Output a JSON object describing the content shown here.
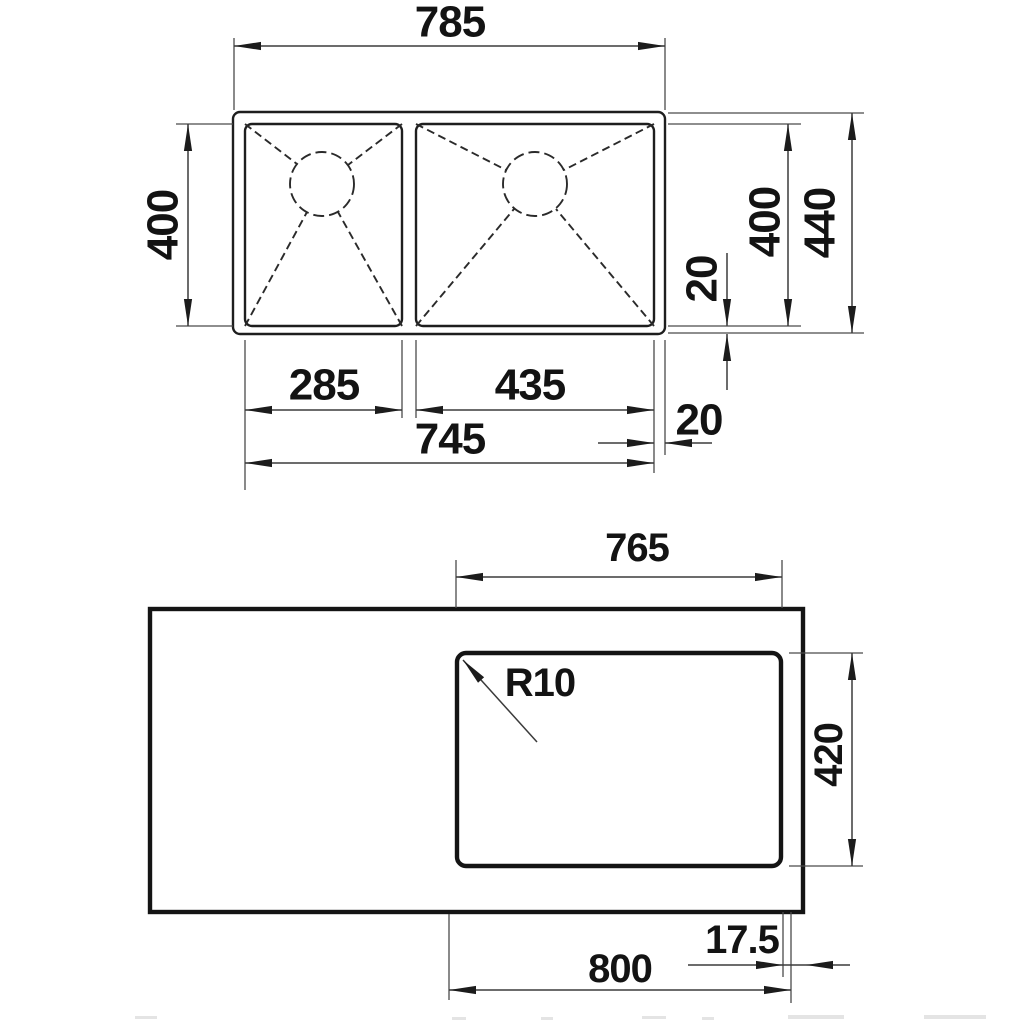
{
  "drawing": {
    "type": "sink installation dimension drawing",
    "line_color": "#1e1e1e",
    "background": "#ffffff",
    "top_view": {
      "description": "plan view of double-bowl sink",
      "dim_overall_width": "785",
      "dim_bowl_depth_left": "400",
      "dim_left_bowl_width": "285",
      "dim_right_bowl_width": "435",
      "dim_bowls_total_width": "745",
      "dim_rim_offset_right": "20",
      "dim_rim_offset_bottom": "20",
      "dim_bowl_depth_right": "400",
      "dim_overall_depth": "440"
    },
    "bottom_view": {
      "description": "countertop cutout view",
      "dim_cutout_width": "765",
      "corner_radius_label": "R10",
      "dim_cutout_depth": "420",
      "dim_edge_offset": "17.5",
      "dim_cabinet_width": "800"
    }
  }
}
